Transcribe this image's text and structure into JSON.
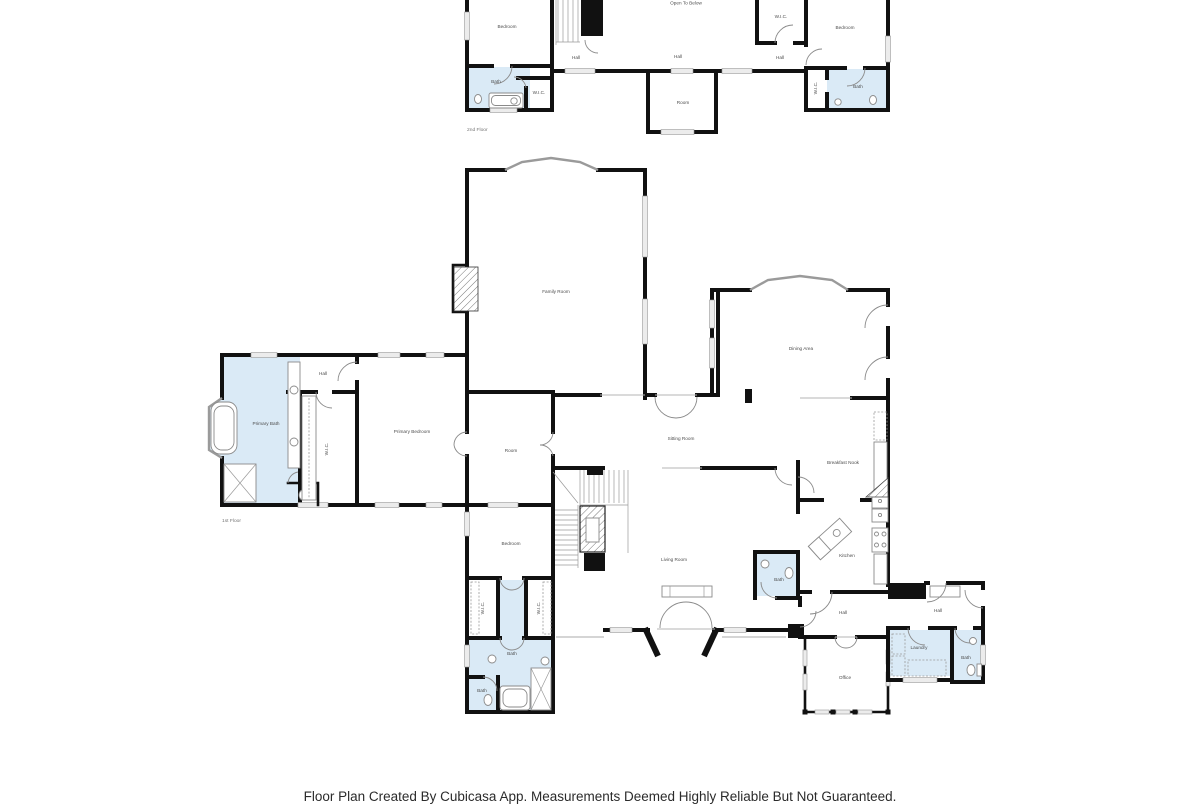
{
  "footer": {
    "text": "Floor Plan Created By Cubicasa App. Measurements Deemed Highly Reliable But Not Guaranteed."
  },
  "colors": {
    "wall": "#111111",
    "bath_fill": "#daeaf6",
    "window_fill": "#ececec",
    "label": "#4d4d4d",
    "floor_label": "#767676"
  },
  "floor2": {
    "label": "2nd Floor",
    "open_to_below": "Open To Below",
    "bedroom_left": "Bedroom",
    "bedroom_right": "Bedroom",
    "wic_top": "W.I.C.",
    "hall_left": "Hall",
    "hall_center": "Hall",
    "hall_right": "Hall",
    "bath_left": "Bath",
    "wic_left": "W.I.C.",
    "room": "Room",
    "wic_right": "W.I.C.",
    "bath_right": "Bath"
  },
  "floor1": {
    "label": "1st Floor",
    "family_room": "Family Room",
    "dining_area": "Dining Area",
    "hall_top": "Hall",
    "primary_bath": "Primary Bath",
    "wic_primary": "W.I.C.",
    "primary_bedroom": "Primary Bedroom",
    "room": "Room",
    "sitting_room": "Sitting Room",
    "breakfast_nook": "Breakfast Nook",
    "bedroom": "Bedroom",
    "living_room": "Living Room",
    "kitchen": "Kitchen",
    "bath_powder": "Bath",
    "hall_kitchen": "Hall",
    "hall_right": "Hall",
    "laundry": "Laundry",
    "bath_right": "Bath",
    "office": "Office",
    "wic_left": "W.I.C.",
    "wic_right": "W.I.C.",
    "bath_main": "Bath",
    "bath_small": "Bath"
  }
}
